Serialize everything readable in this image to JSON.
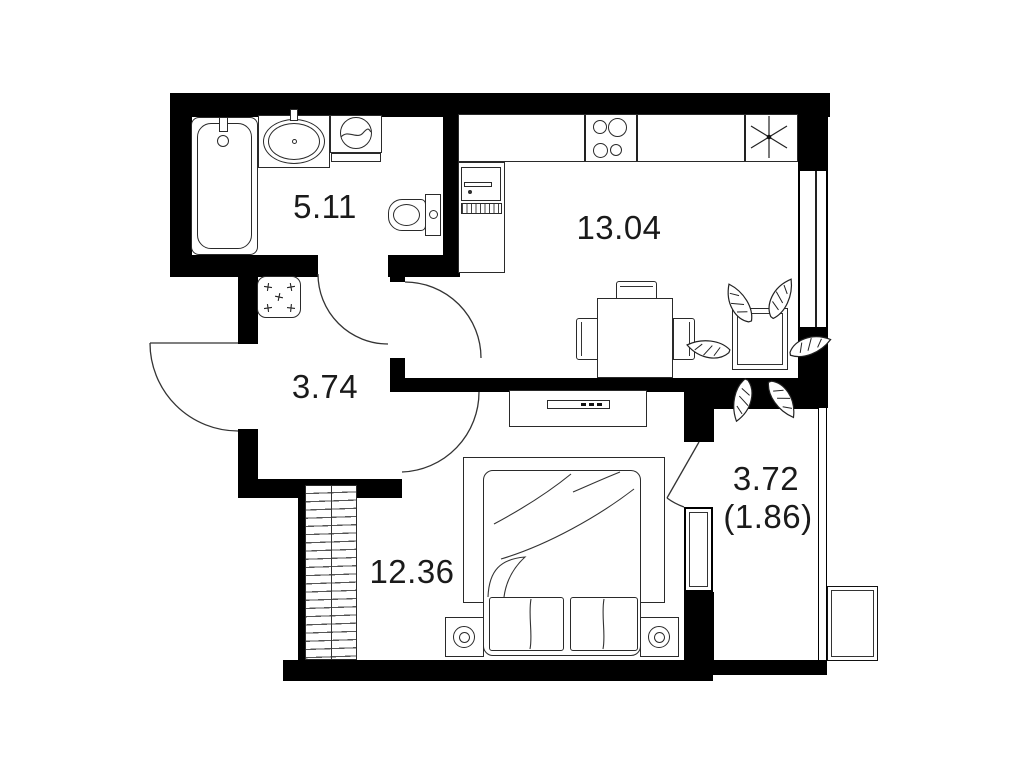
{
  "plan": {
    "type": "apartment-floor-plan",
    "rooms": [
      {
        "key": "bathroom",
        "area": "5.11"
      },
      {
        "key": "kitchen-living",
        "area": "13.04"
      },
      {
        "key": "hallway",
        "area": "3.74"
      },
      {
        "key": "bedroom",
        "area": "12.36"
      },
      {
        "key": "balcony",
        "area": "3.72",
        "area_secondary": "(1.86)"
      }
    ],
    "fixtures": [
      "bathtub",
      "washbasin",
      "washing-machine",
      "toilet",
      "doormat",
      "kitchen-counter",
      "stove",
      "vent-shaft",
      "kitchen-sink",
      "drainboard",
      "dining-table",
      "chairs",
      "plant",
      "tv-console",
      "wardrobe",
      "bed",
      "pillows",
      "nightstands",
      "lamps",
      "air-conditioner",
      "entrance-door",
      "bathroom-door",
      "kitchen-door",
      "bedroom-door",
      "balcony-door",
      "windows"
    ],
    "icons": {
      "vent_shaft": "asterisk",
      "doormat_marks": "+"
    },
    "colors": {
      "wall": "#000000",
      "stroke": "#2a2a2a",
      "background": "#ffffff",
      "text": "#1a1a1a"
    }
  }
}
